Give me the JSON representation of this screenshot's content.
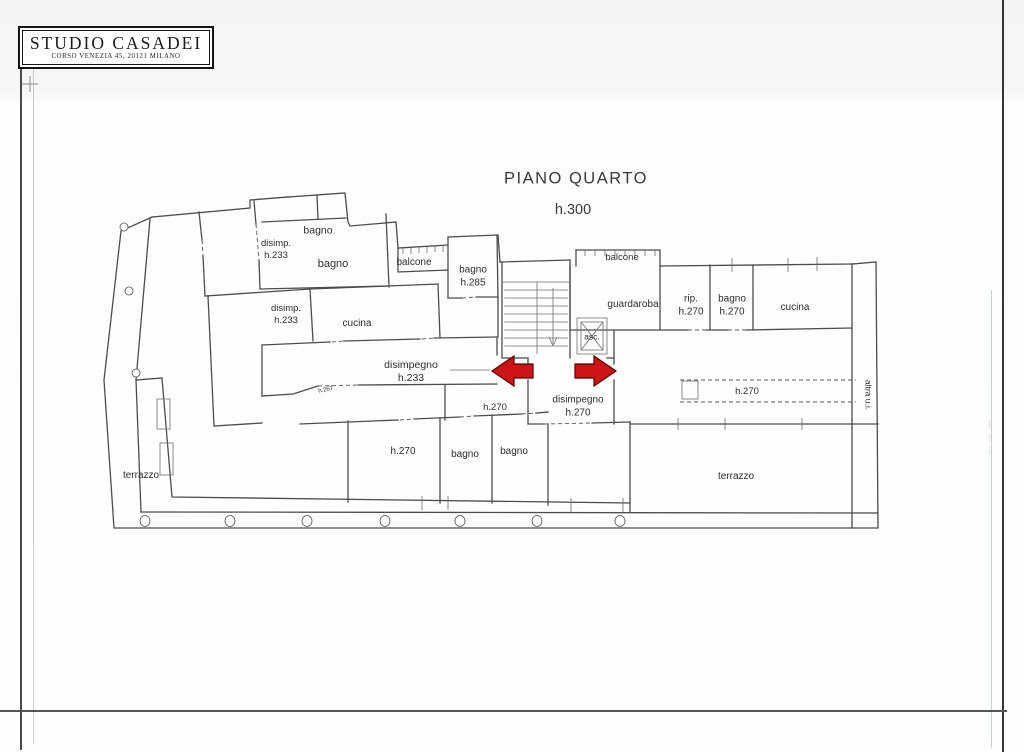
{
  "title_block": {
    "studio_name": "STUDIO CASADEI",
    "address": "CORSO VENEZIA 45, 20121 MILANO"
  },
  "plan": {
    "title": "PIANO QUARTO",
    "floor_height": "h.300",
    "rooms": {
      "disimp_top": "disimp.\nh.233",
      "bagno_top_small": "bagno",
      "bagno_top_large": "bagno",
      "disimp_mid": "disimp.\nh.233",
      "cucina_left": "cucina",
      "balcone_left": "balcone",
      "bagno_h285": "bagno\nh.285",
      "disimpegno_left": "disimpegno\nh.233",
      "h267_note": "h.267",
      "h270_landing": "h.270",
      "disimpegno_center": "disimpegno\nh.270",
      "balcone_right": "balcone",
      "guardaroba": "guardaroba",
      "ripostiglio": "rip.\nh.270",
      "bagno_right": "bagno\nh.270",
      "cucina_right": "cucina",
      "elevator": "asc.",
      "h270_strip": "h.270",
      "h270_room": "h.270",
      "bagno_bottom_left": "bagno",
      "bagno_bottom_right": "bagno",
      "terrazzo_left": "terrazzo",
      "terrazzo_right": "terrazzo",
      "adjacent_unit": "altra u.i."
    }
  },
  "colors": {
    "arrow_red": "#cc1414",
    "wall_gray": "#4c4c4c"
  }
}
